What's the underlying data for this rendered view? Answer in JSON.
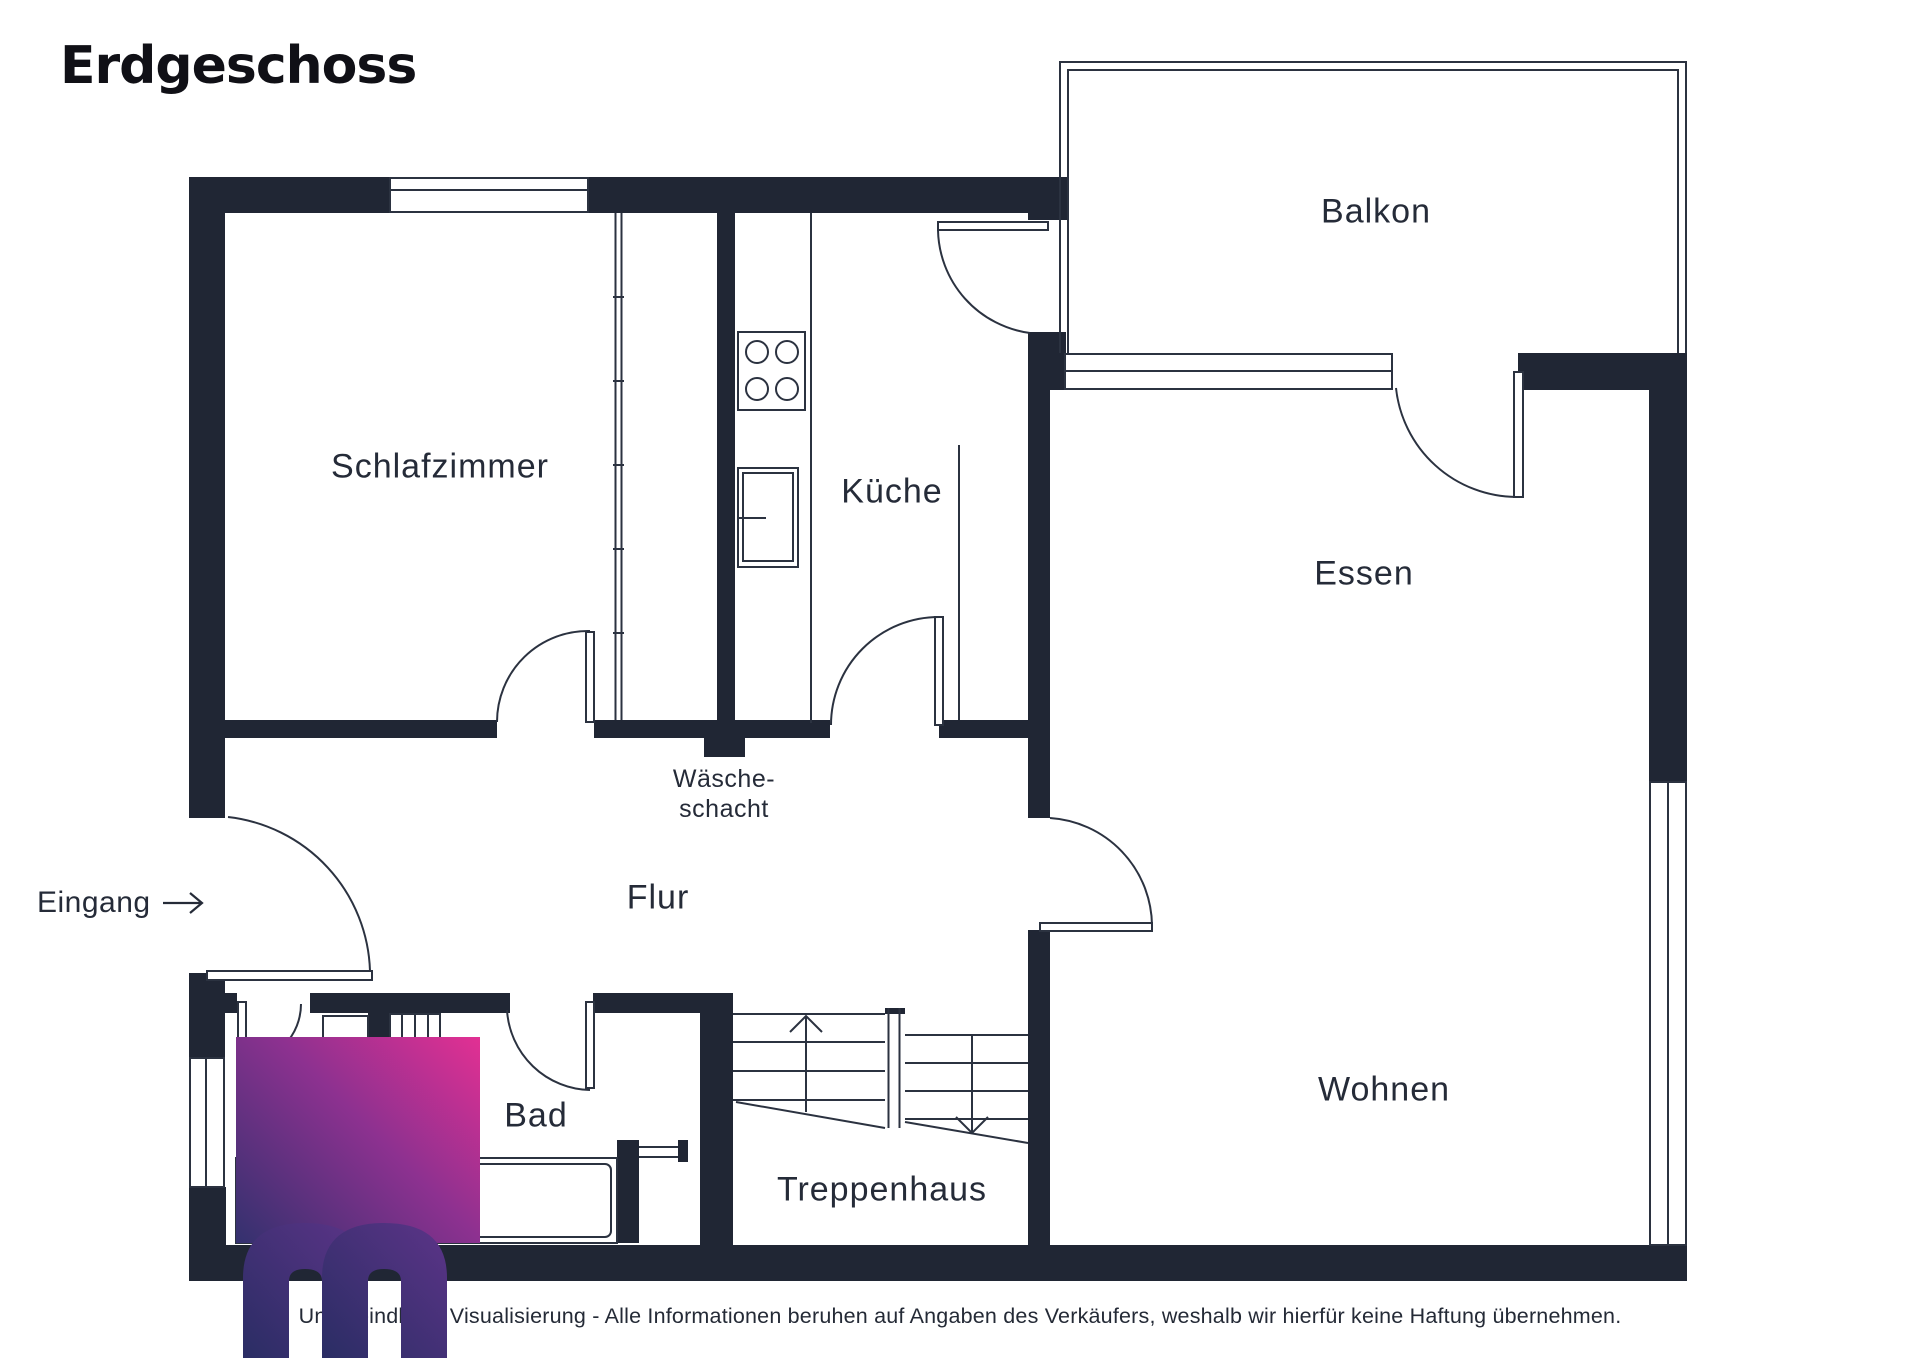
{
  "title": "Erdgeschoss",
  "rooms": {
    "schlafzimmer": {
      "label": "Schlafzimmer"
    },
    "kueche": {
      "label": "Küche"
    },
    "balkon": {
      "label": "Balkon"
    },
    "essen": {
      "label": "Essen"
    },
    "wohnen": {
      "label": "Wohnen"
    },
    "flur": {
      "label": "Flur"
    },
    "bad": {
      "label": "Bad"
    },
    "treppenhaus": {
      "label": "Treppenhaus"
    },
    "waescheschacht": {
      "line1": "Wäsche-",
      "line2": "schacht"
    }
  },
  "entrance": {
    "label": "Eingang",
    "arrow_icon": "→"
  },
  "disclaimer": "Unverbindliche Visualisierung - Alle Informationen beruhen auf Angaben des Verkäufers, weshalb wir hierfür keine Haftung übernehmen.",
  "colors": {
    "wall": "#202634",
    "thin_line": "#2b3240",
    "label_text": "#252b38",
    "title_text": "#101016",
    "watermark_dark": "#33316e",
    "watermark_mid": "#8d3190",
    "watermark_pink": "#e23093",
    "watermark_m": "#2d2f6a"
  }
}
